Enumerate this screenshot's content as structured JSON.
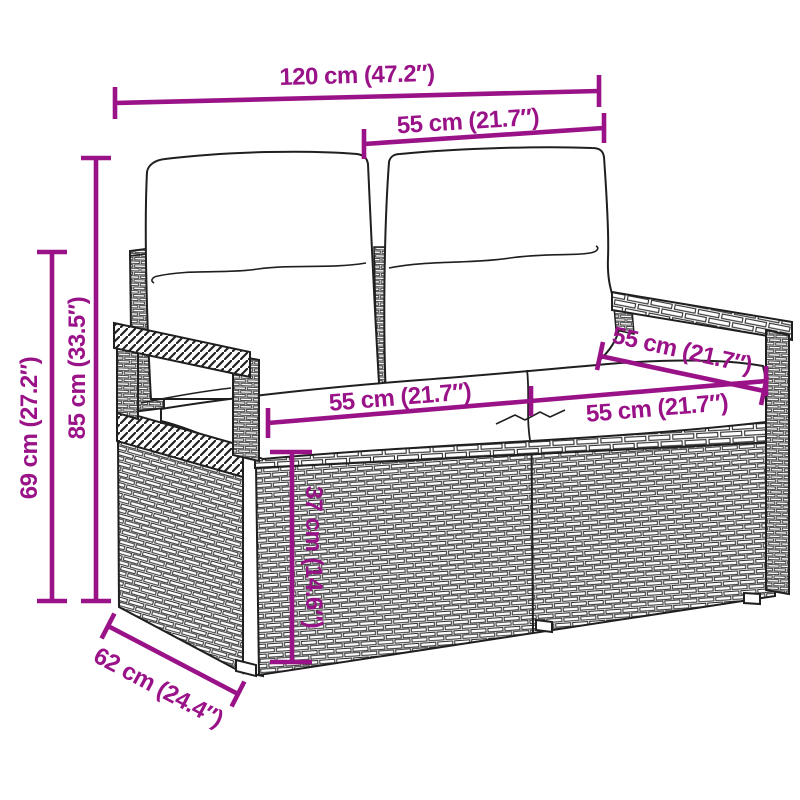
{
  "diagram": {
    "colors": {
      "dimension_accent": "#9A1288",
      "line_art": "#1f1f1f",
      "background": "#ffffff"
    },
    "dimensions": {
      "overall_width": "120 cm (47.2″)",
      "backrest_section_width": "55 cm (21.7″)",
      "overall_height": "85 cm (33.5″)",
      "armrest_height": "69 cm (27.2″)",
      "seat_width_left": "55 cm (21.7″)",
      "seat_width_right": "55 cm (21.7″)",
      "seat_depth": "55 cm (21.7″)",
      "seat_height": "37 cm (14.6″)",
      "overall_depth": "62 cm (24.4″)"
    }
  }
}
